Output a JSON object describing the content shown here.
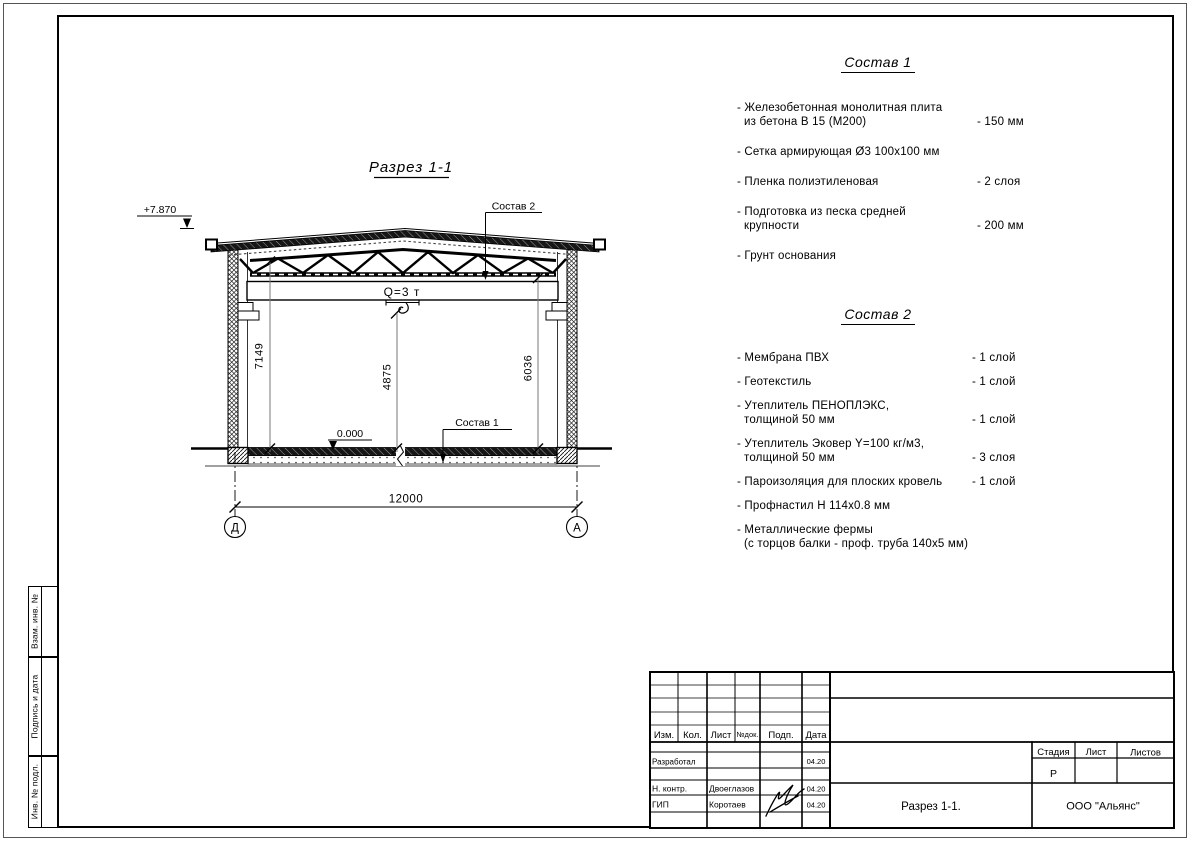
{
  "colors": {
    "ink": "#000000",
    "dim_line": "#777777"
  },
  "drawing": {
    "title": "Разрез 1-1",
    "elevation_top": "+7.870",
    "elevation_zero": "0.000",
    "crane_capacity": "Q=3 т",
    "dim_height_left": "7149",
    "dim_height_hook": "4875",
    "dim_height_right": "6036",
    "dim_span": "12000",
    "axis_left": "Д",
    "axis_right": "А",
    "callout_roof": "Состав 2",
    "callout_floor": "Состав 1"
  },
  "sostav1": {
    "title": "Состав 1",
    "items": [
      {
        "line1": "- Железобетонная  монолитная плита",
        "line2": "из бетона В 15 (М200)",
        "value": "- 150 мм"
      },
      {
        "line1": "- Сетка армирующая Ø3 100х100 мм"
      },
      {
        "line1": "- Пленка полиэтиленовая",
        "value": "-  2 слоя"
      },
      {
        "line1": "- Подготовка из песка средней",
        "line2": "крупности",
        "value": "- 200 мм"
      },
      {
        "line1": "- Грунт основания"
      }
    ]
  },
  "sostav2": {
    "title": "Состав 2",
    "items": [
      {
        "line1": "- Мембрана ПВХ",
        "value": "- 1 слой"
      },
      {
        "line1": "- Геотекстиль",
        "value": "- 1 слой"
      },
      {
        "line1": "- Утеплитель ПЕНОПЛЭКС,",
        "line2": "толщиной 50 мм",
        "value": "- 1 слой"
      },
      {
        "line1": "- Утеплитель Эковер Y=100 кг/м3,",
        "line2": "толщиной 50 мм",
        "value": "- 3 слоя"
      },
      {
        "line1": "- Пароизоляция для плоских кровель",
        "value": "- 1 слой"
      },
      {
        "line1": "- Профнастил Н 114х0.8 мм"
      },
      {
        "line1": "- Металлические фермы",
        "line2": "(с торцов балки - проф. труба 140х5 мм)"
      }
    ]
  },
  "titleblock": {
    "col_izm": "Изм.",
    "col_kol": "Кол.",
    "col_list": "Лист",
    "col_ndok": "№док.",
    "col_podp": "Подп.",
    "col_data": "Дата",
    "row_developer_role": "Разработал",
    "row_developer_date": "04.20",
    "row_ncontrol_role": "Н. контр.",
    "row_ncontrol_name": "Двоеглазов",
    "row_ncontrol_date": "04.20",
    "row_gip_role": "ГИП",
    "row_gip_name": "Коротаев",
    "row_gip_date": "04.20",
    "stage_label": "Стадия",
    "sheet_label": "Лист",
    "sheets_label": "Листов",
    "stage_value": "Р",
    "doc_title": "Разрез 1-1.",
    "company": "ООО \"Альянс\""
  },
  "side_stamp": {
    "top": "Взам. инв. №",
    "middle": "Подпись и дата",
    "bottom": "Инв. № подл."
  }
}
